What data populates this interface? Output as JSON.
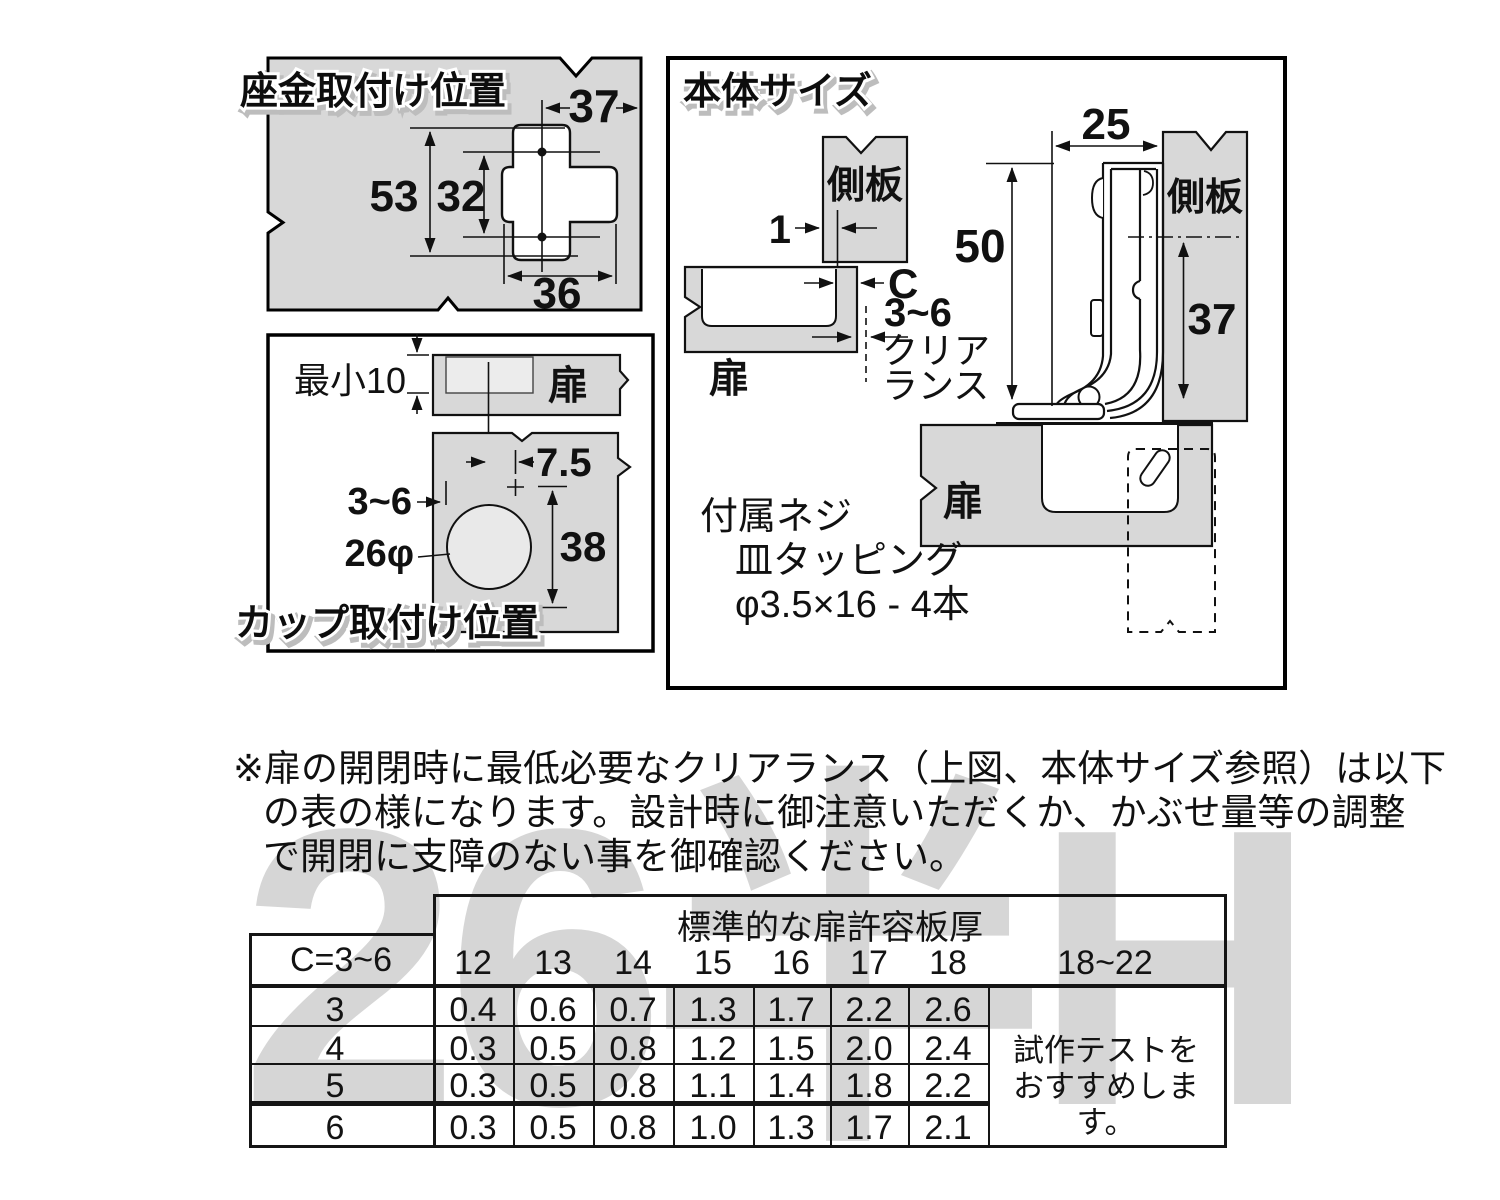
{
  "colors": {
    "panel_gray": "#d8d8d8",
    "inner_gray": "#ececec",
    "circle_gray": "#e9e9e9",
    "line": "#111111",
    "watermark": "#d6d6d6"
  },
  "watermark": {
    "text": "26半H"
  },
  "plate_panel": {
    "title": "座金取付け位置",
    "dim_width_top": "37",
    "dim_height_outer": "53",
    "dim_hole_pitch": "32",
    "dim_width_bottom": "36"
  },
  "cup_panel": {
    "title": "カップ取付け位置",
    "door_label": "扉",
    "min_edge_label": "最小10",
    "dim_screw_offset": "7.5",
    "dim_edge_distance": "3~6",
    "dim_cup_diameter": "26φ",
    "dim_screw_pitch": "38"
  },
  "body_panel": {
    "title": "本体サイズ",
    "side_panel_label_top": "側板",
    "side_panel_label_right": "側板",
    "door_label_left": "扉",
    "door_label_bottom": "扉",
    "dim_overlay": "1",
    "clearance_letter": "C",
    "clearance_range": "3~6",
    "clearance_label_1": "クリア",
    "clearance_label_2": "ランス",
    "dim_depth": "25",
    "dim_height": "50",
    "dim_center": "37",
    "screw_line_1": "付属ネジ",
    "screw_line_2": "皿タッピング",
    "screw_line_3": "φ3.5×16 - 4本"
  },
  "note": {
    "line_1": "※扉の開閉時に最低必要なクリアランス（上図、本体サイズ参照）は以下",
    "line_2": "の表の様になります。設計時に御注意いただくか、かぶせ量等の調整",
    "line_3": "で開閉に支障のない事を御確認ください。"
  },
  "table": {
    "header_title": "標準的な扉許容板厚",
    "corner_header": "C=3~6",
    "columns": [
      "12",
      "13",
      "14",
      "15",
      "16",
      "17",
      "18",
      "18~22"
    ],
    "rows": [
      {
        "label": "3",
        "values": [
          "0.4",
          "0.6",
          "0.7",
          "1.3",
          "1.7",
          "2.2",
          "2.6"
        ]
      },
      {
        "label": "4",
        "values": [
          "0.3",
          "0.5",
          "0.8",
          "1.2",
          "1.5",
          "2.0",
          "2.4"
        ]
      },
      {
        "label": "5",
        "values": [
          "0.3",
          "0.5",
          "0.8",
          "1.1",
          "1.4",
          "1.8",
          "2.2"
        ]
      },
      {
        "label": "6",
        "values": [
          "0.3",
          "0.5",
          "0.8",
          "1.0",
          "1.3",
          "1.7",
          "2.1"
        ]
      }
    ],
    "advisory_line_1": "試作テストを",
    "advisory_line_2": "おすすめします。"
  }
}
